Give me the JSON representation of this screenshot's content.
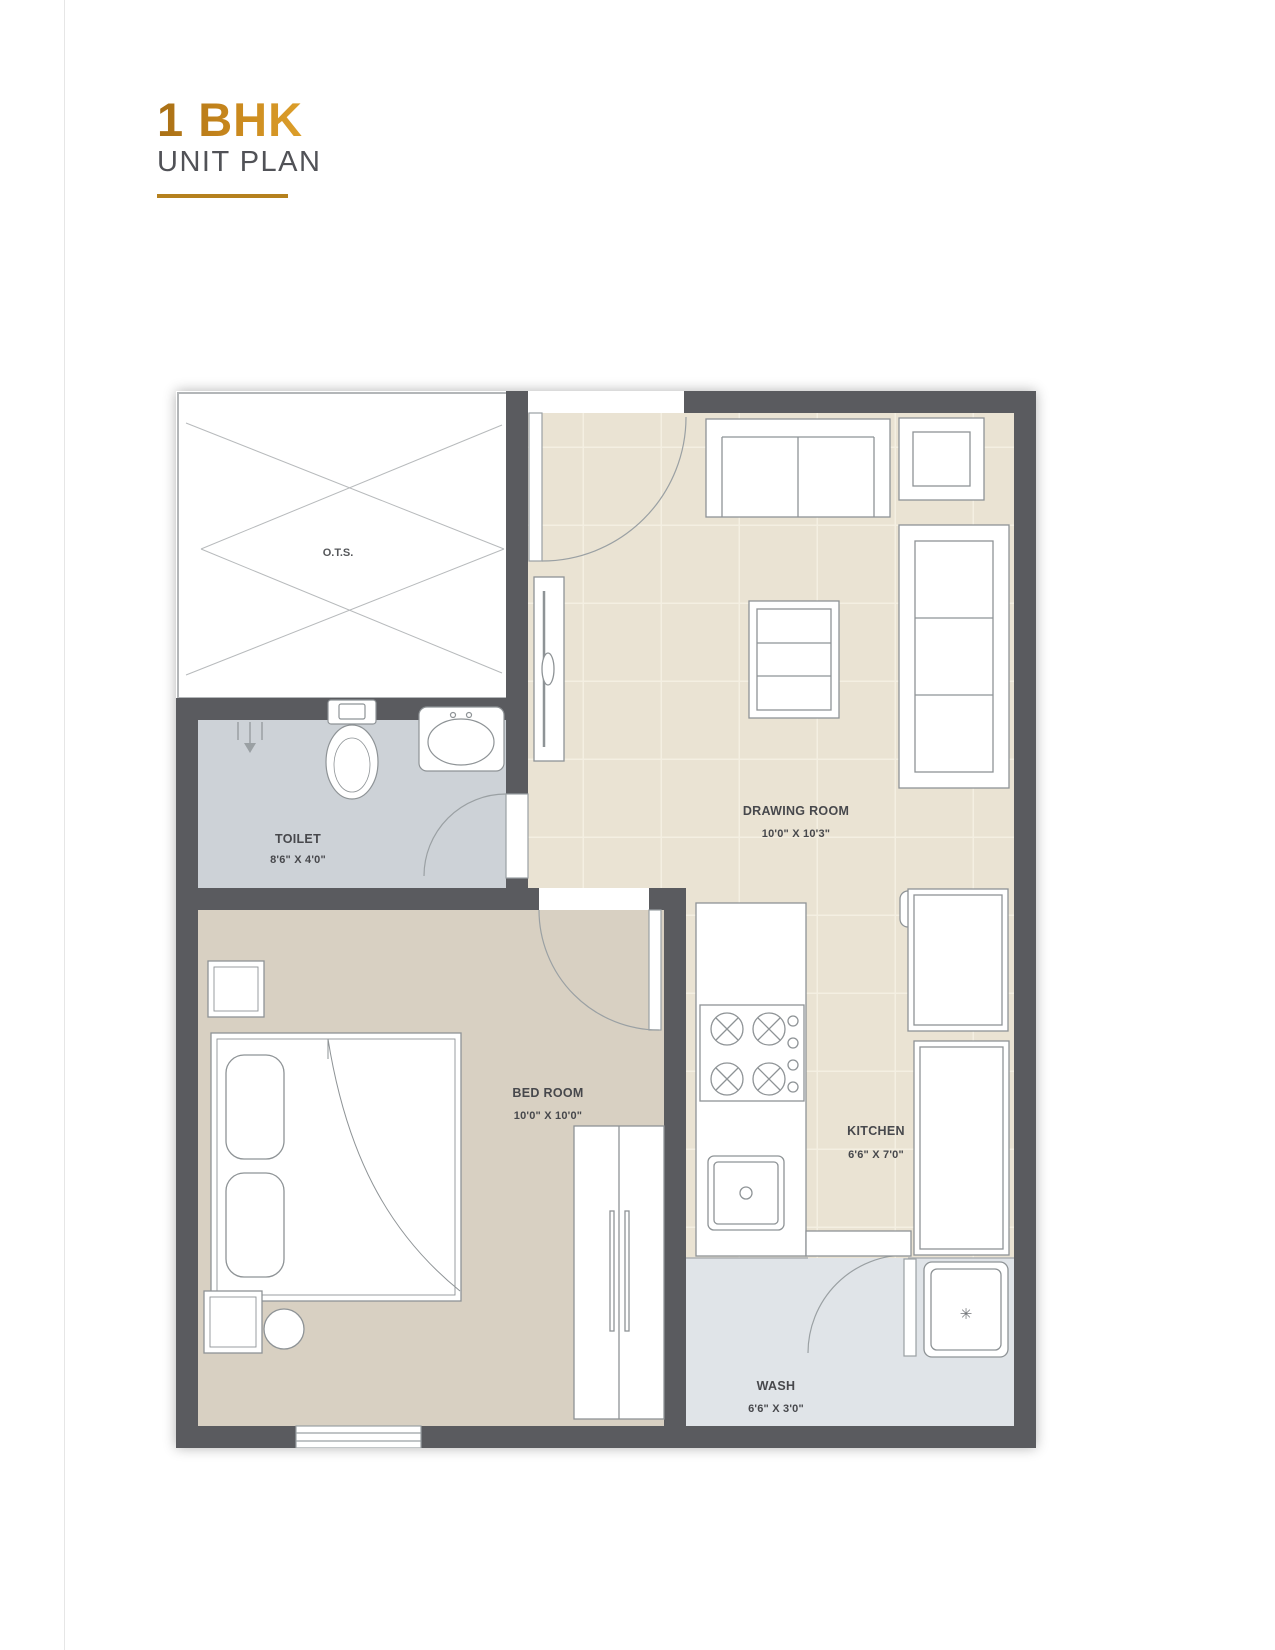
{
  "page": {
    "title": "1 BHK",
    "subtitle": "UNIT PLAN"
  },
  "rooms": {
    "ots": {
      "label": "O.T.S."
    },
    "toilet": {
      "label": "TOILET",
      "dims": "8'6\" X 4'0\""
    },
    "drawing_room": {
      "label": "DRAWING ROOM",
      "dims": "10'0\" X 10'3\""
    },
    "bed_room": {
      "label": "BED ROOM",
      "dims": "10'0\" X 10'0\""
    },
    "kitchen": {
      "label": "KITCHEN",
      "dims": "6'6\" X 7'0\""
    },
    "wash": {
      "label": "WASH",
      "dims": "6'6\" X 3'0\""
    }
  },
  "icons": {
    "washing_machine_dial": "✳"
  },
  "colors": {
    "accent_gold": "#b5811e",
    "title_gold": "#c8871d",
    "subtitle_gray": "#515257",
    "wall": "#5a5b5f",
    "drawing_kitchen_floor": "#eae3d3",
    "tile_line": "#f4efe2",
    "bedroom_floor": "#d8d0c2",
    "toilet_floor": "#cdd2d7",
    "wash_floor": "#e0e4e8",
    "furniture_line": "#8e9396"
  }
}
